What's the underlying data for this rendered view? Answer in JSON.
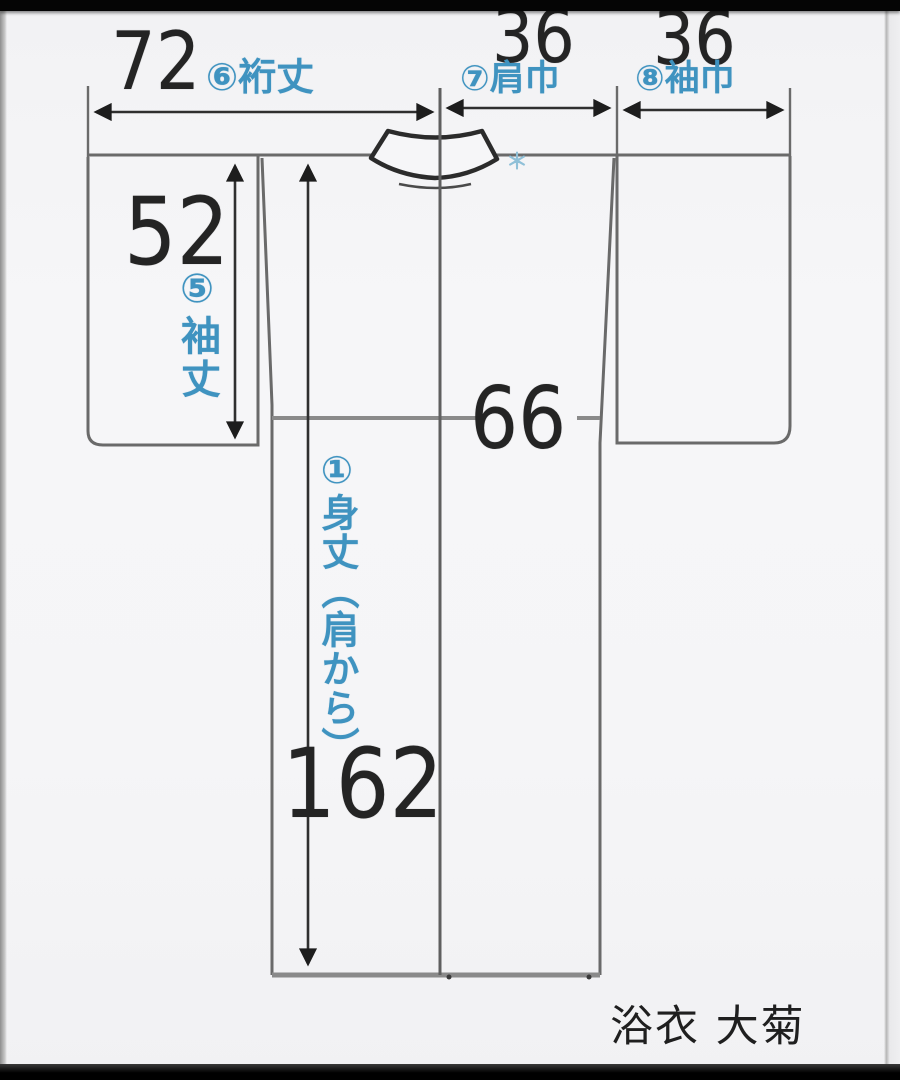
{
  "diagram": {
    "kind": "yukata-measurement-diagram",
    "caption": "浴衣 大菊",
    "collar_mark": "＊",
    "measurements": {
      "yukitake": {
        "value": "72",
        "label": "⑥裄丈"
      },
      "katahaba": {
        "value": "36",
        "label": "⑦肩巾"
      },
      "sodehaba": {
        "value": "36",
        "label": "⑧袖巾"
      },
      "sodetake": {
        "value": "52",
        "label": "⑤袖丈"
      },
      "mihaba": {
        "value": "66",
        "label": ""
      },
      "mitake": {
        "value": "162",
        "label": "①身丈（肩から）"
      }
    },
    "colors": {
      "label_blue": "#3f93c0",
      "ink_black": "#242424",
      "outline_gray": "#6a6a6a",
      "dimension_dark": "#2f2f2f",
      "background": "#f5f5f7"
    }
  }
}
